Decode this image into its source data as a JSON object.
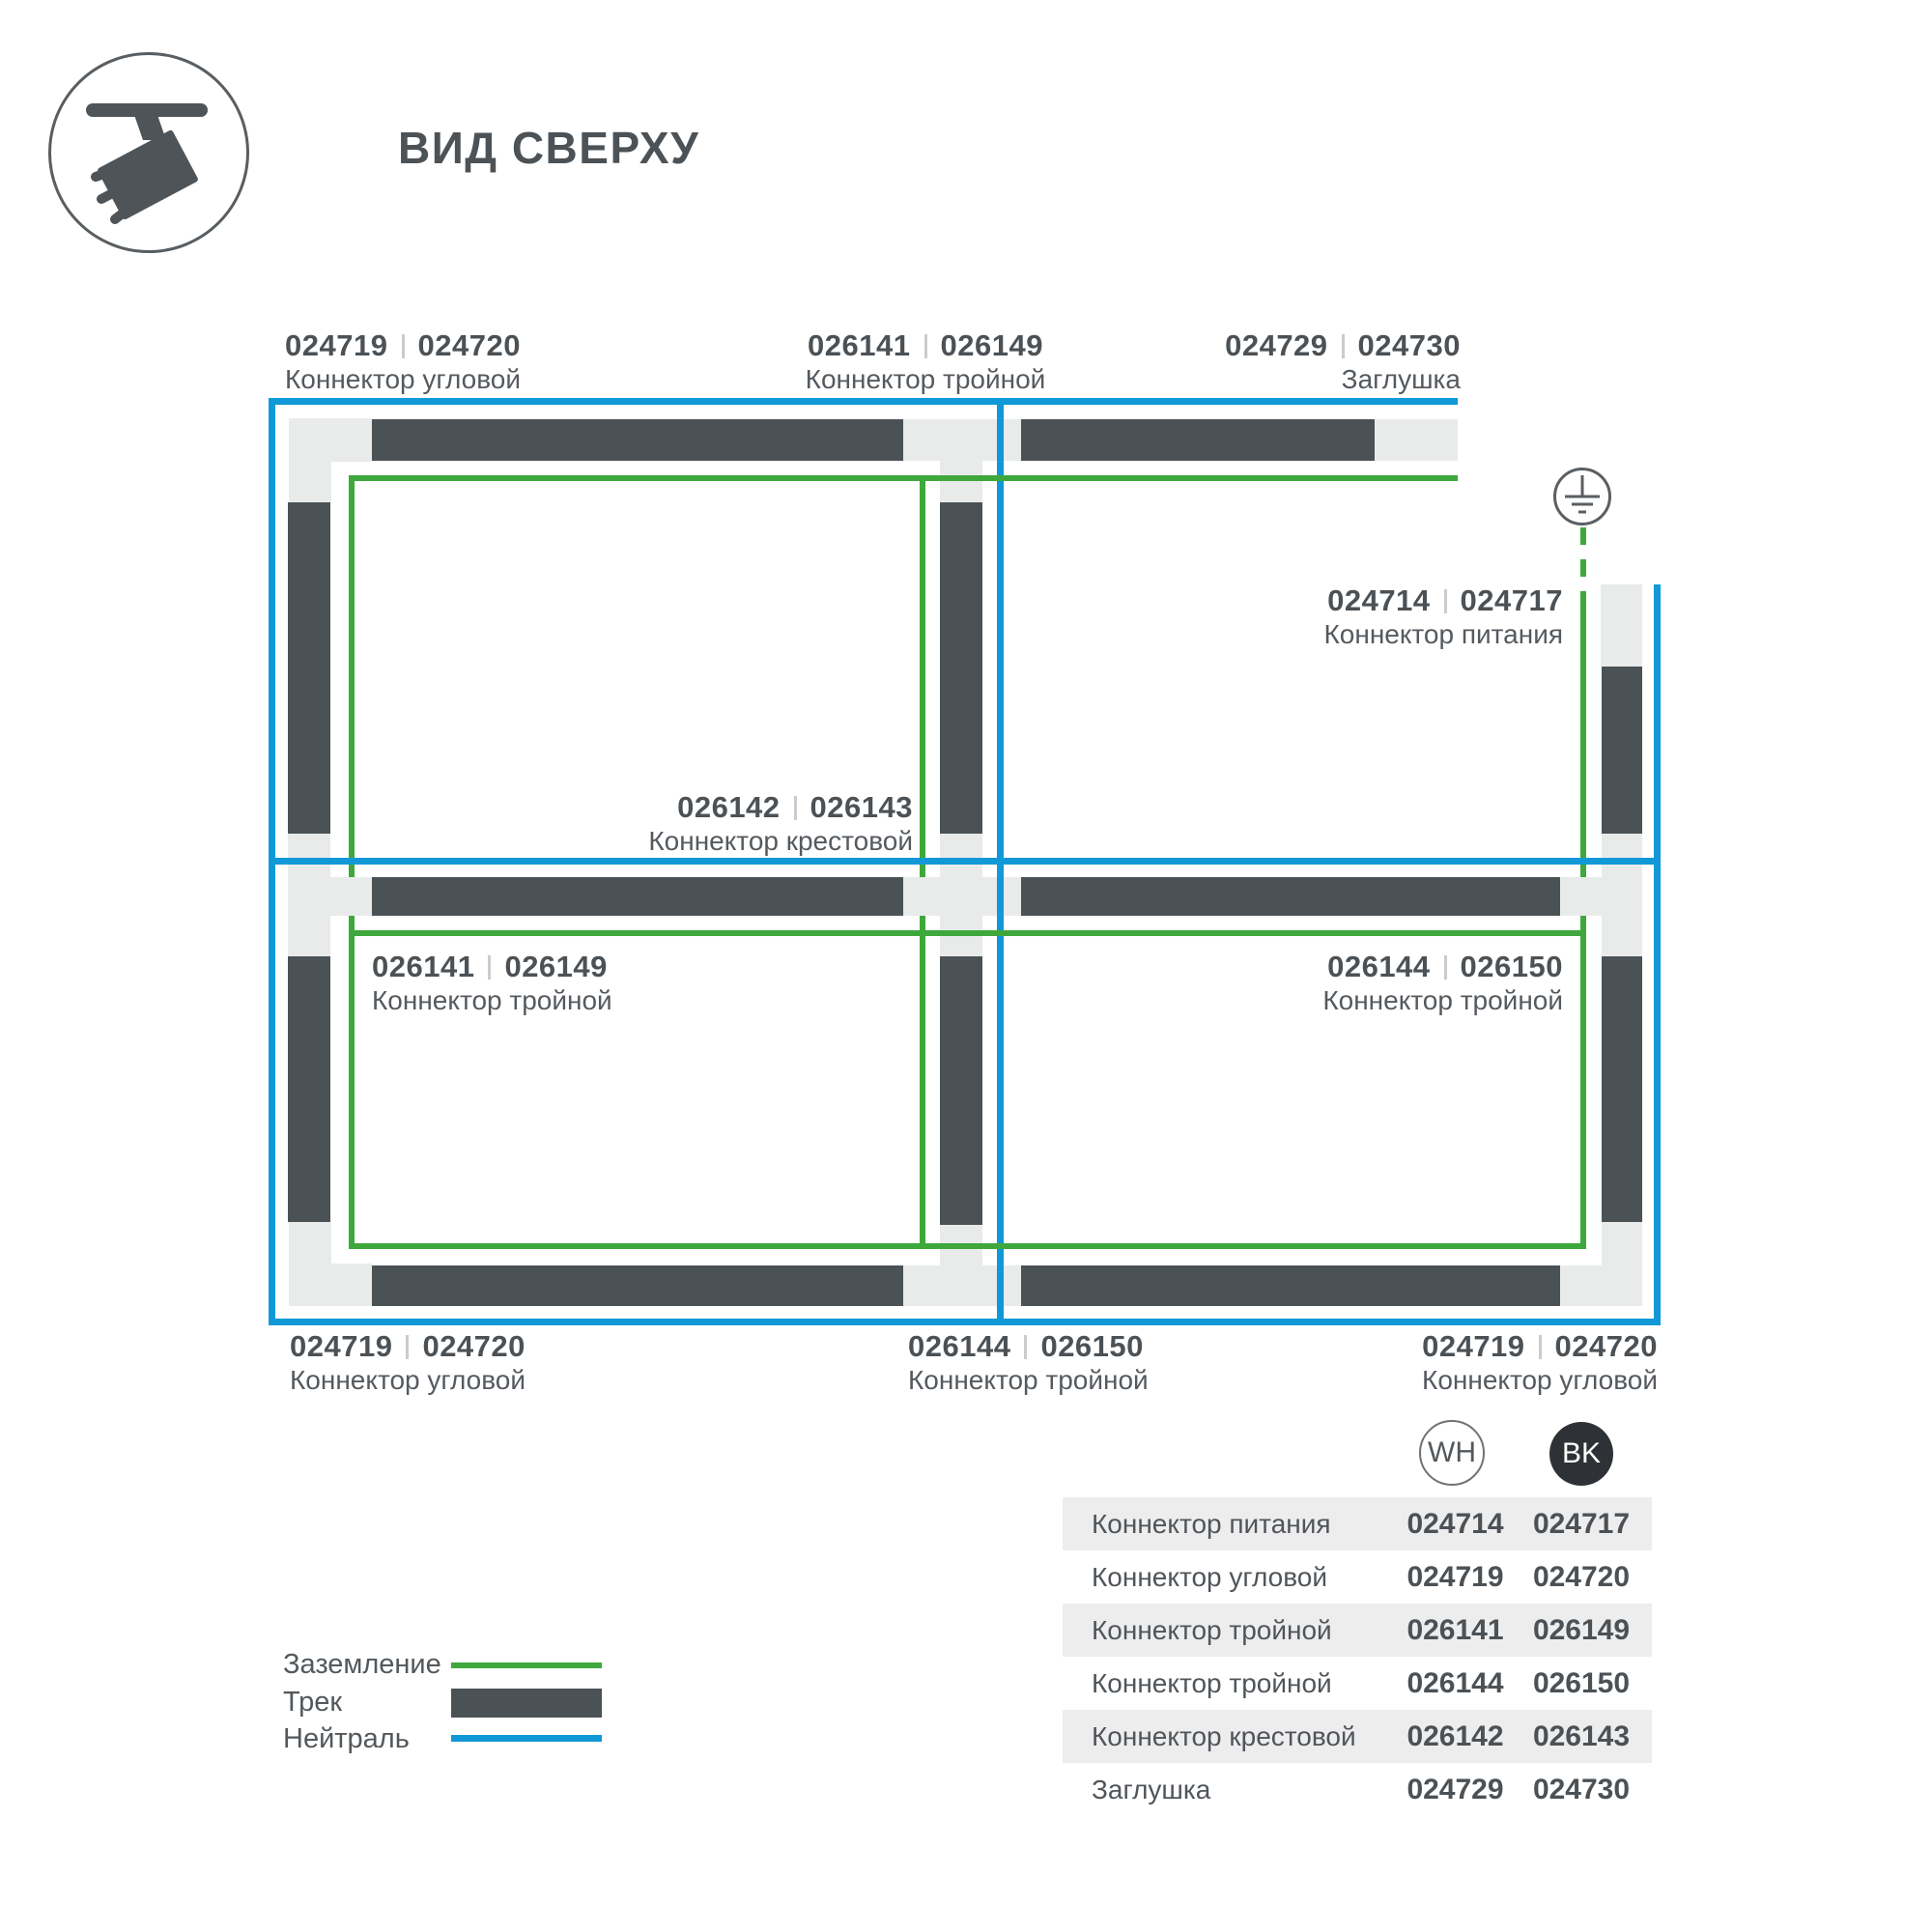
{
  "header": {
    "title": "ВИД СВЕРХУ"
  },
  "colors": {
    "track": "#4b5256",
    "connector": "#e9ebeb",
    "ground_green": "#3fa83c",
    "neutral_blue": "#1099d6",
    "text": "#555a5f",
    "badge_black": "#2e3236",
    "table_stripe": "#ededee"
  },
  "diagram": {
    "labels": [
      {
        "wh": "024719",
        "bk": "024720",
        "name": "Коннектор угловой"
      },
      {
        "wh": "026141",
        "bk": "026149",
        "name": "Коннектор тройной"
      },
      {
        "wh": "024729",
        "bk": "024730",
        "name": "Заглушка"
      },
      {
        "wh": "024714",
        "bk": "024717",
        "name": "Коннектор питания"
      },
      {
        "wh": "026142",
        "bk": "026143",
        "name": "Коннектор крестовой"
      },
      {
        "wh": "026141",
        "bk": "026149",
        "name": "Коннектор тройной"
      },
      {
        "wh": "026144",
        "bk": "026150",
        "name": "Коннектор тройной"
      },
      {
        "wh": "024719",
        "bk": "024720",
        "name": "Коннектор угловой"
      },
      {
        "wh": "026144",
        "bk": "026150",
        "name": "Коннектор тройной"
      },
      {
        "wh": "024719",
        "bk": "024720",
        "name": "Коннектор угловой"
      }
    ],
    "icons": [
      "track-spotlight-icon",
      "earth-ground-icon"
    ]
  },
  "legend": {
    "items": [
      {
        "label": "Заземление",
        "swatch": "ground-line"
      },
      {
        "label": "Трек",
        "swatch": "track-bar"
      },
      {
        "label": "Нейтраль",
        "swatch": "neutral-line"
      }
    ]
  },
  "variants": {
    "wh": "WH",
    "bk": "BK"
  },
  "table": {
    "rows": [
      {
        "name": "Коннектор питания",
        "wh": "024714",
        "bk": "024717"
      },
      {
        "name": "Коннектор угловой",
        "wh": "024719",
        "bk": "024720"
      },
      {
        "name": "Коннектор тройной",
        "wh": "026141",
        "bk": "026149"
      },
      {
        "name": "Коннектор тройной",
        "wh": "026144",
        "bk": "026150"
      },
      {
        "name": "Коннектор крестовой",
        "wh": "026142",
        "bk": "026143"
      },
      {
        "name": "Заглушка",
        "wh": "024729",
        "bk": "024730"
      }
    ]
  }
}
